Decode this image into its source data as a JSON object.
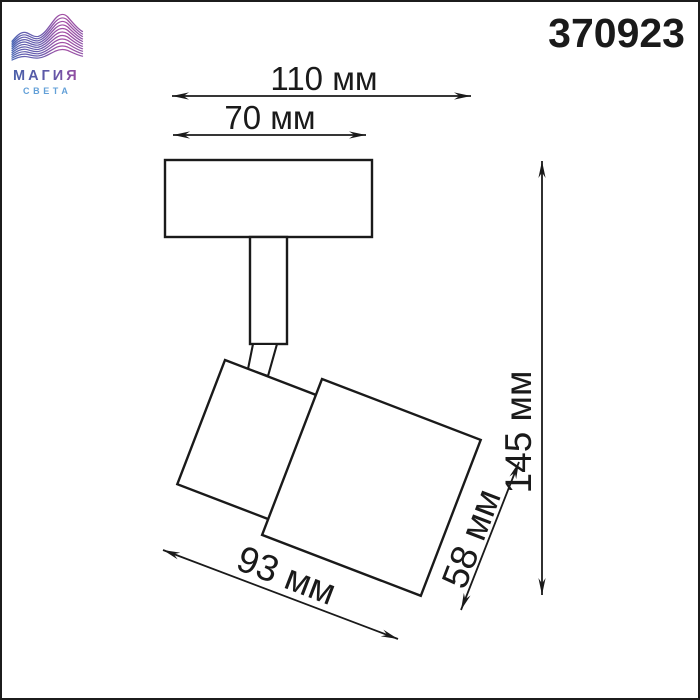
{
  "page": {
    "background": "#ffffff",
    "border_color": "#1c1c1c"
  },
  "logo": {
    "brand_line1": "МАГИЯ",
    "brand_line2": "СВЕТА",
    "wave_gradient_start": "#4a67b4",
    "wave_gradient_mid": "#7a58ab",
    "wave_gradient_end": "#b04ea3",
    "brand_gradient_start": "#4b60a9",
    "brand_gradient_end": "#9a4da1",
    "subtitle_color": "#63a0d8"
  },
  "product": {
    "number": "370923"
  },
  "drawing": {
    "stroke_color": "#1a1a1a",
    "fixture_fill": "#ffffff"
  },
  "dimensions": {
    "overall_width": "110 мм",
    "base_width": "70 мм",
    "overall_height": "145 мм",
    "head_depth": "58 мм",
    "head_length": "93 мм"
  }
}
